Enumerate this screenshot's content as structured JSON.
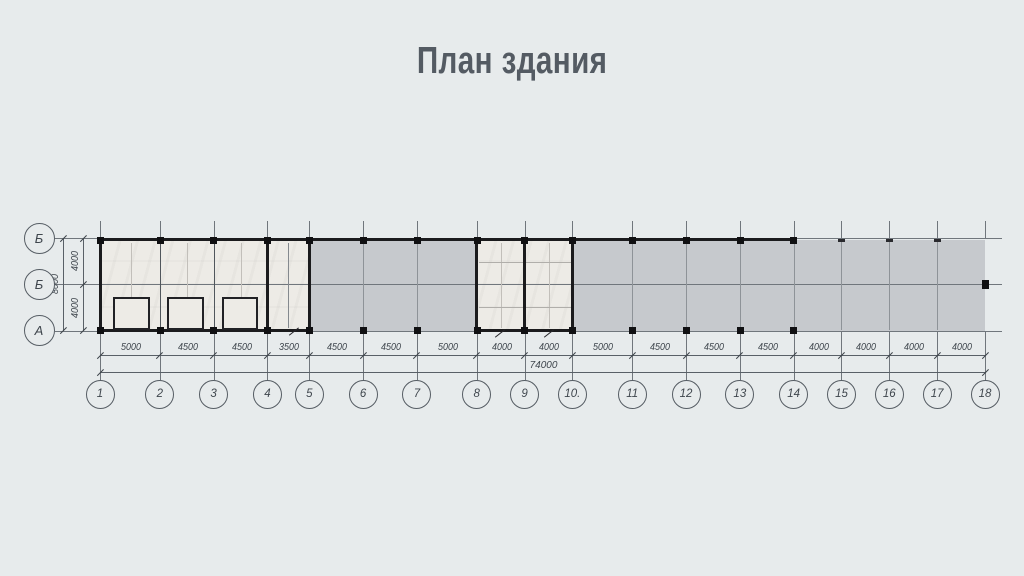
{
  "title": "План здания",
  "colors": {
    "background": "#e7ebec",
    "floor_gray": "#c6c9cd",
    "room_white": "#edebe6",
    "wall_black": "#1b1b1d",
    "grid_line": "#8e9398",
    "outer_line": "#70767c",
    "dim_line": "#596067",
    "tick": "#3d4349",
    "dim_text": "#3f464d",
    "faint_line": "#c2bfba",
    "partition_line": "#50565c",
    "title_text": "#545b63"
  },
  "axes": {
    "bottom": [
      "1",
      "2",
      "3",
      "4",
      "5",
      "6",
      "7",
      "8",
      "9",
      "10.",
      "11",
      "12",
      "13",
      "14",
      "15",
      "16",
      "17",
      "18"
    ],
    "left": [
      "Б",
      "Б",
      "А"
    ]
  },
  "dimensions": {
    "bays_mm": [
      5000,
      4500,
      4500,
      3500,
      4500,
      4500,
      5000,
      4000,
      4000,
      5000,
      4500,
      4500,
      4500,
      4000,
      4000,
      4000,
      4000
    ],
    "total_label": "74000",
    "left_bay_top": "4000",
    "left_bay_bottom": "4000",
    "left_total": "8000"
  }
}
